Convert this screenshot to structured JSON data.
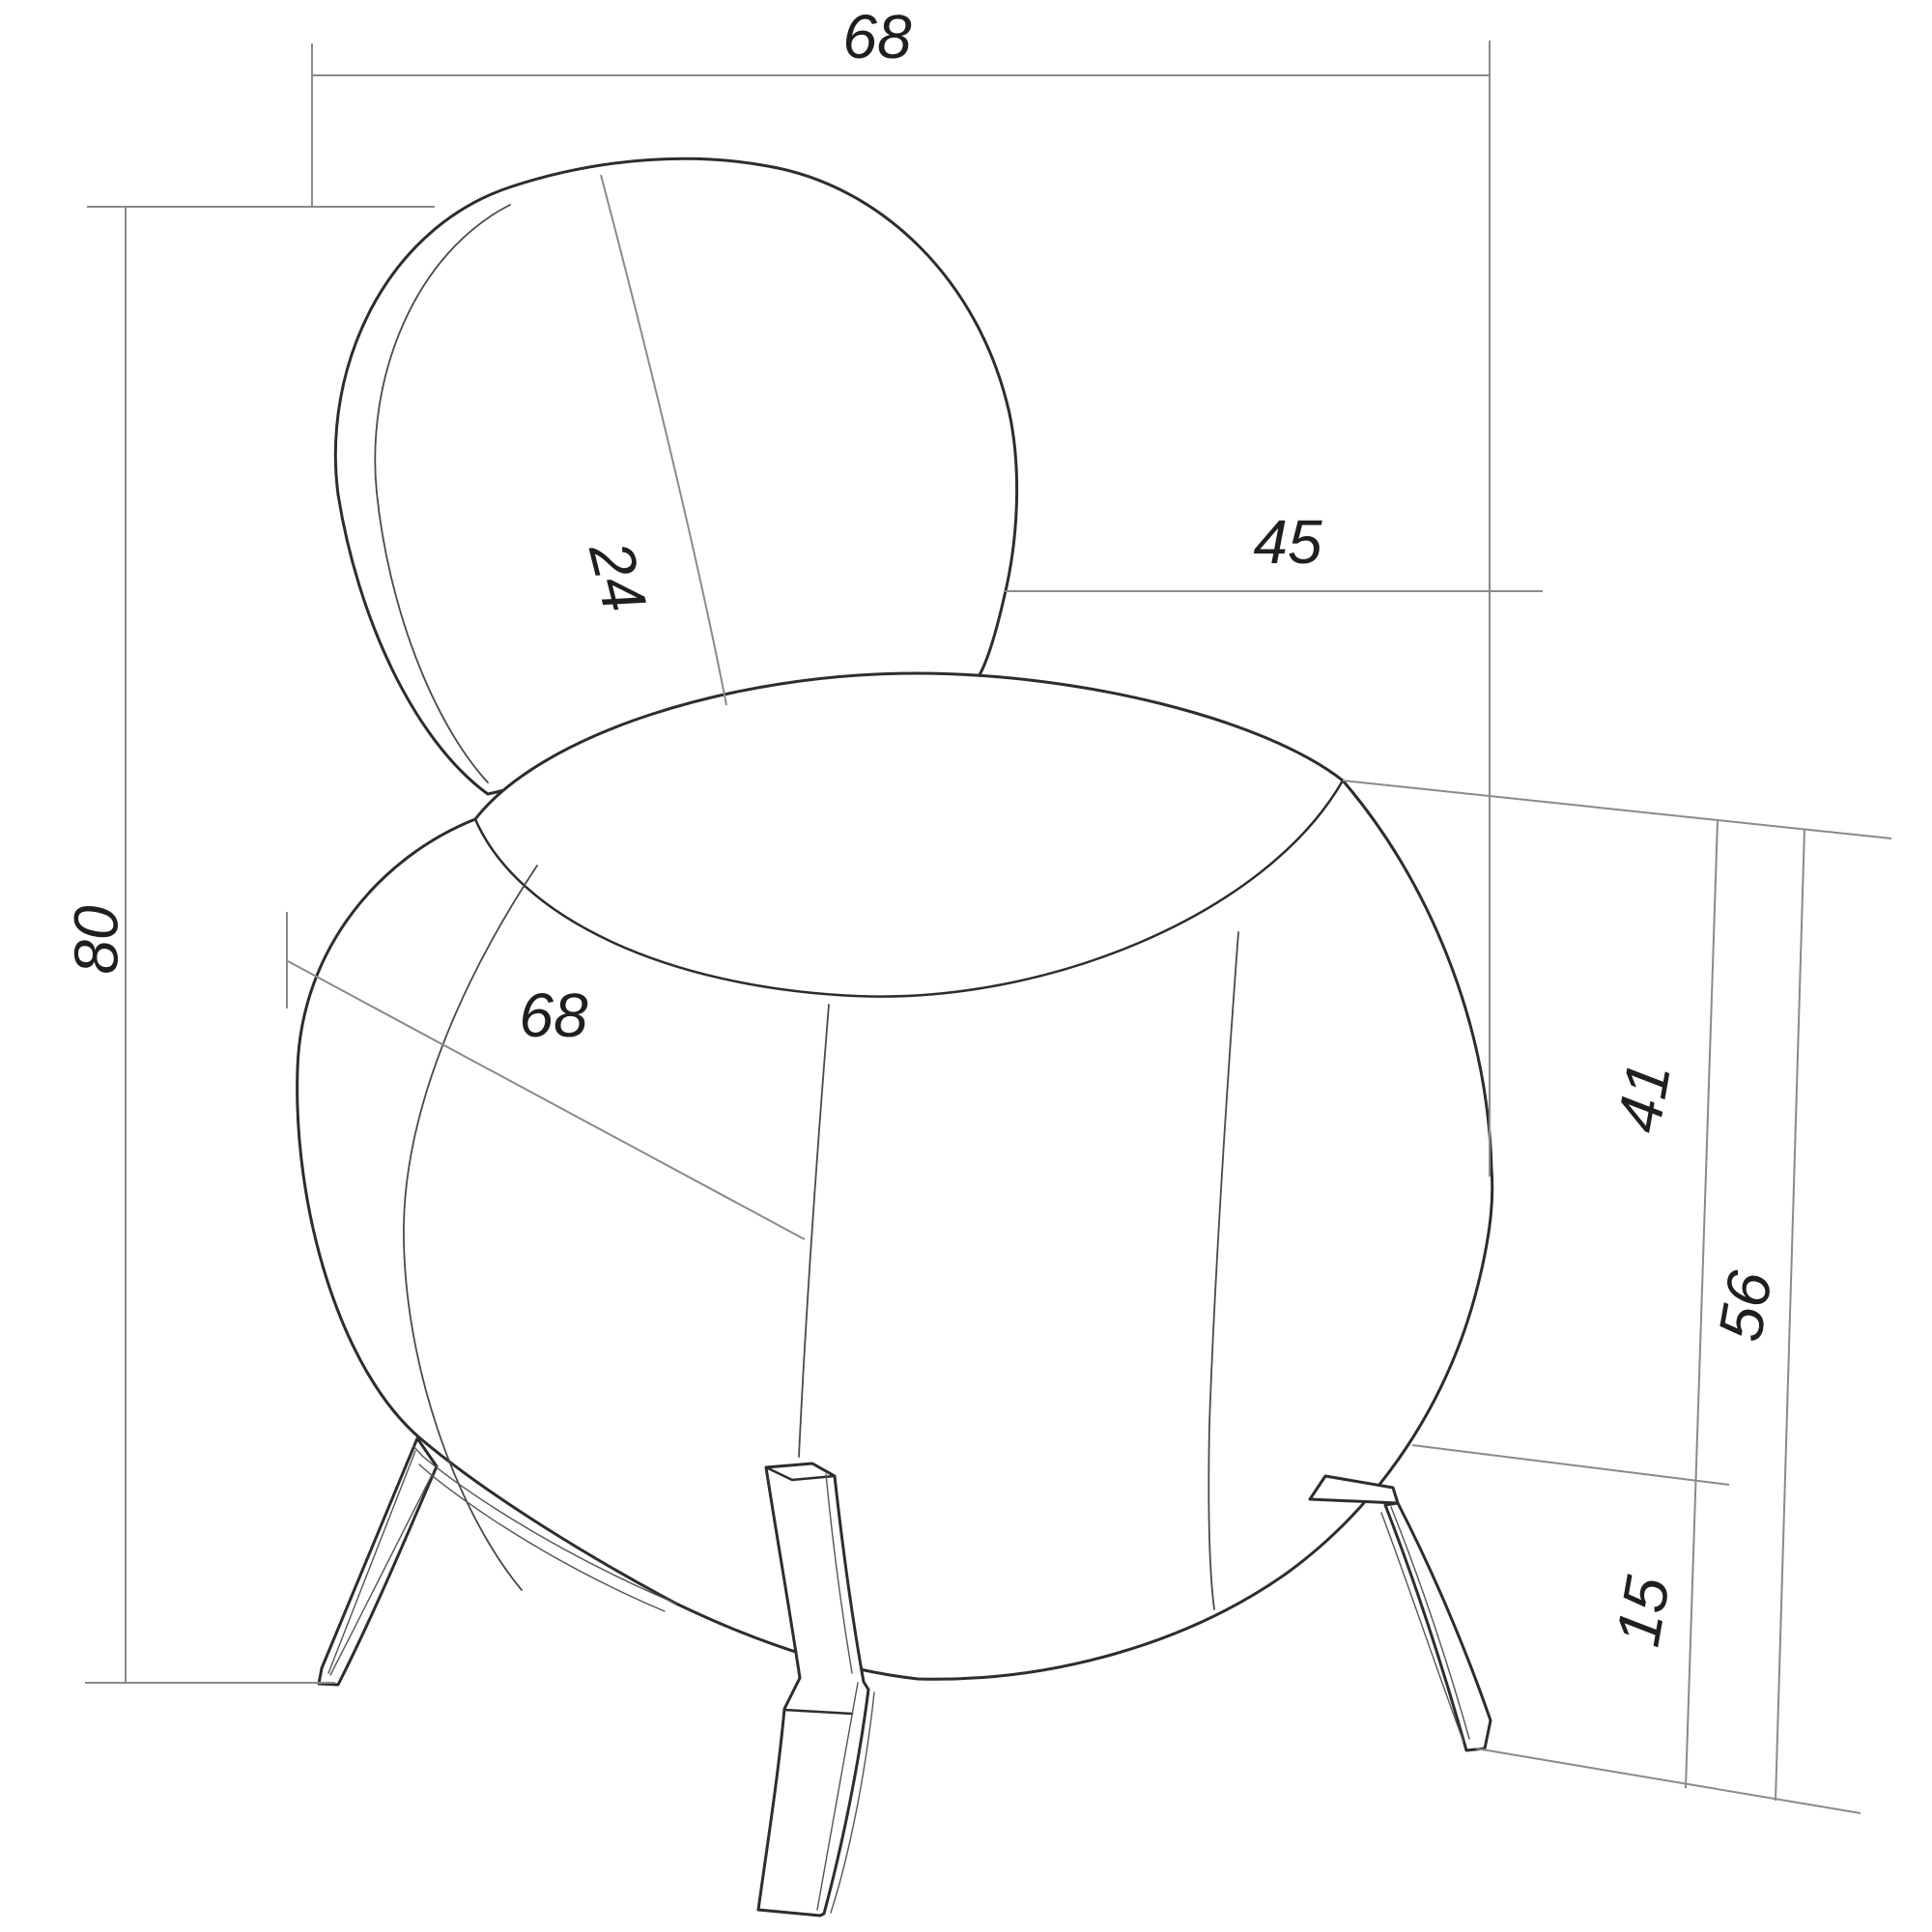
{
  "drawing": {
    "type": "furniture-dimension-drawing",
    "subject": "round pouf lounge chair with oval backrest and splayed legs, three-quarter view",
    "background": "#ffffff",
    "colors": {
      "outline": "#2d2d2d",
      "seam": "#4a4a4a",
      "dimension_line": "#8a8a8a",
      "label": "#1f1f1f"
    },
    "dimensions": {
      "backrest_width": "68",
      "overall_height": "80",
      "backrest_thickness": "24",
      "backrest_height_above_seat": "45",
      "seat_diameter": "68",
      "seat_clearance_height": "41",
      "seat_surface_height": "56",
      "leg_height": "15"
    }
  }
}
